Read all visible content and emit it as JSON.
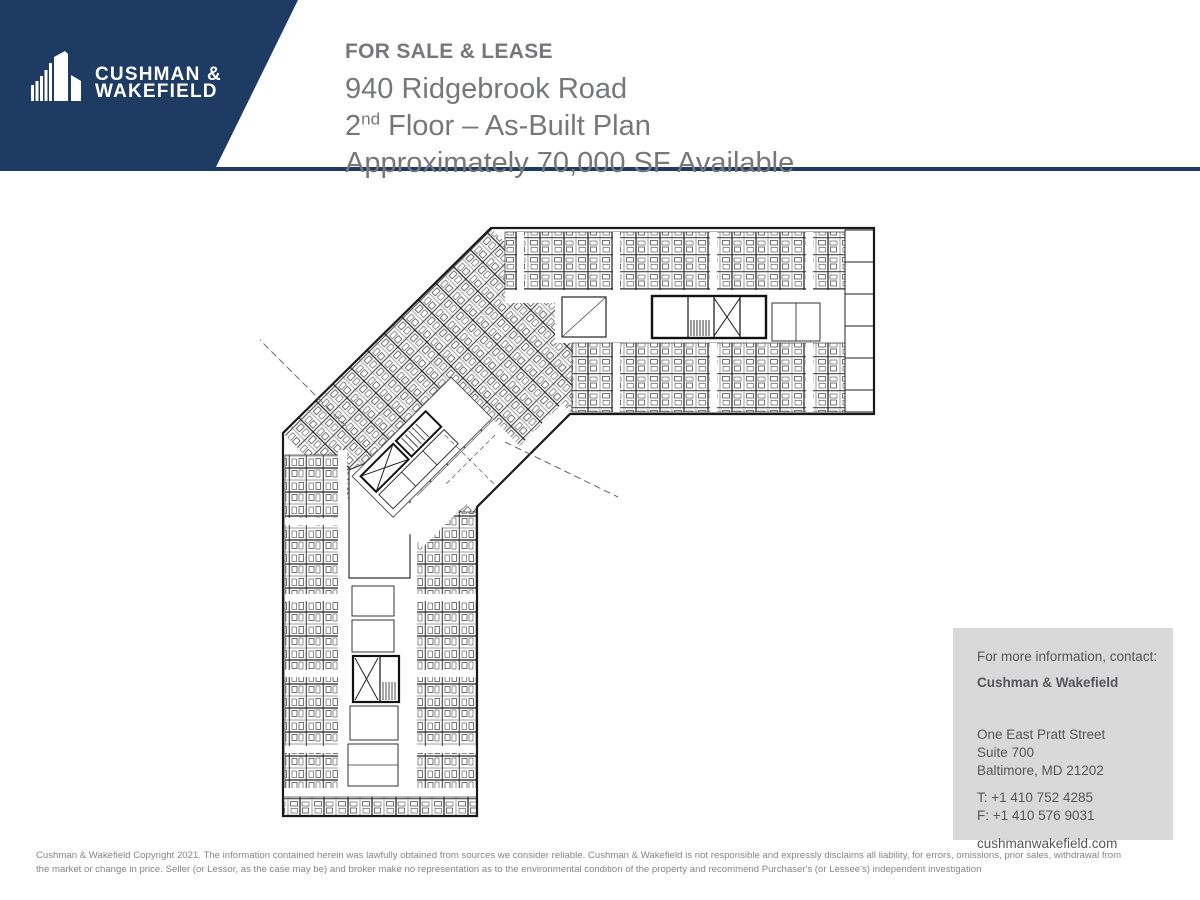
{
  "banner": {
    "logo_line1": "CUSHMAN &",
    "logo_line2": "WAKEFIELD",
    "brand_navy": "#1e3c63"
  },
  "header": {
    "eyebrow": "FOR SALE & LEASE",
    "line1": "940 Ridgebrook Road",
    "floor_num": "2",
    "floor_sup": "nd",
    "floor_rest": " Floor – As-Built Plan",
    "line3": "Approximately 70,000 SF Available",
    "text_gray": "#76777b"
  },
  "contact": {
    "intro": "For more information, contact:",
    "company": "Cushman & Wakefield",
    "address1": "One East Pratt Street",
    "address2": "Suite 700",
    "address3": "Baltimore, MD 21202",
    "phone": "T: +1 410 752 4285",
    "fax": "F: +1 410 576 9031",
    "website": "cushmanwakefield.com",
    "box_gray": "#d9d9d9"
  },
  "footer": {
    "line1": "Cushman & Wakefield Copyright 2021. The information contained herein was lawfully obtained from sources we consider reliable. Cushman & Wakefield is not responsible and expressly disclaims all liability, for errors, omissions, prior sales,  withdrawal from",
    "line2": "the market or change in price. Seller (or Lessor, as the case may be) and broker make no representation as to the environmental condition of the property and recommend Purchaser's (or Lessee's) independent investigation"
  }
}
